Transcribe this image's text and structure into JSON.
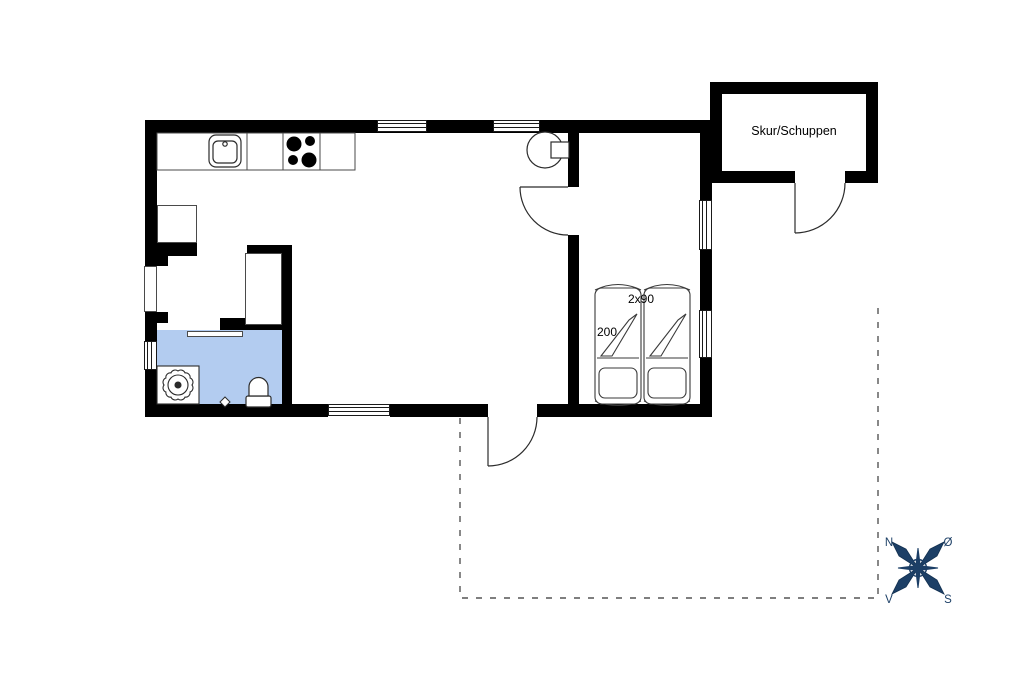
{
  "labels": {
    "shed": "Skur/Schuppen",
    "bed_size": "2x90",
    "bed_length": "200"
  },
  "compass": {
    "n": "N",
    "e": "Ø",
    "s": "S",
    "w": "V"
  },
  "colors": {
    "wall": "#000000",
    "thin_line": "#2b2b2b",
    "bathroom_floor": "#b3ccf0",
    "compass": "#1c3f66",
    "terrace_dash": "#555555",
    "background": "#ffffff"
  }
}
